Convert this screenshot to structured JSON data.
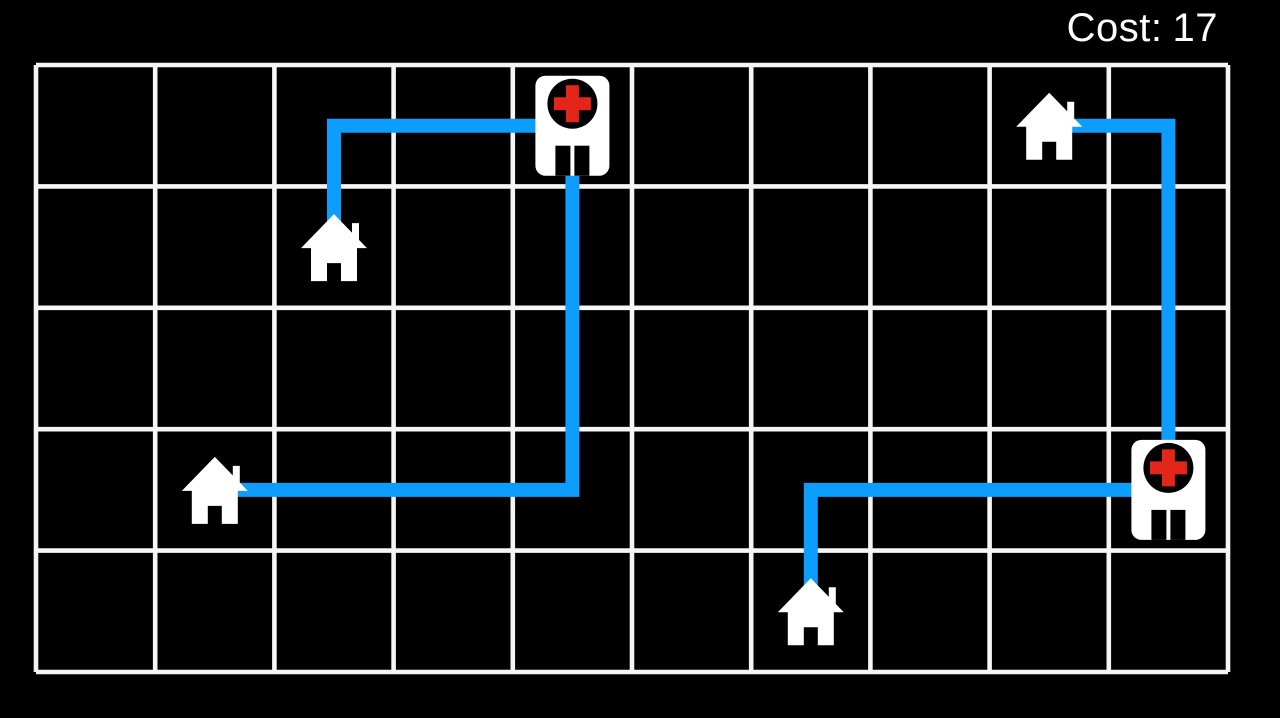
{
  "hud": {
    "label": "Cost:",
    "value": "17"
  },
  "board": {
    "columns": 10,
    "rows": 5,
    "x": 36,
    "y": 65,
    "cell_width": 119.2,
    "cell_height": 121.4,
    "grid_line_width": 4.6
  },
  "style": {
    "background": "#000000",
    "grid_color": "#f5f5f5",
    "route_color": "#0d9dff",
    "route_width": 14,
    "building_color": "#ffffff",
    "cross_color": "#e3261a",
    "icon_contrast_color": "#000000",
    "hud_color": "#ffffff"
  },
  "buildings": [
    {
      "id": "hospital-1",
      "type": "hospital",
      "row": 1,
      "col": 5
    },
    {
      "id": "hospital-2",
      "type": "hospital",
      "row": 4,
      "col": 10
    },
    {
      "id": "house-1",
      "type": "house",
      "row": 2,
      "col": 3
    },
    {
      "id": "house-2",
      "type": "house",
      "row": 4,
      "col": 2
    },
    {
      "id": "house-3",
      "type": "house",
      "row": 1,
      "col": 9
    },
    {
      "id": "house-4",
      "type": "house",
      "row": 5,
      "col": 7
    }
  ],
  "routes": [
    {
      "id": "route-house-1-hospital-1",
      "from": "house-1",
      "to": "hospital-1",
      "cells": [
        [
          2,
          3
        ],
        [
          1,
          3
        ],
        [
          1,
          5
        ]
      ]
    },
    {
      "id": "route-house-2-hospital-1",
      "from": "house-2",
      "to": "hospital-1",
      "cells": [
        [
          4,
          2
        ],
        [
          4,
          5
        ],
        [
          1,
          5
        ]
      ]
    },
    {
      "id": "route-house-3-hospital-2",
      "from": "house-3",
      "to": "hospital-2",
      "cells": [
        [
          1,
          9
        ],
        [
          1,
          10
        ],
        [
          4,
          10
        ]
      ]
    },
    {
      "id": "route-house-4-hospital-2",
      "from": "house-4",
      "to": "hospital-2",
      "cells": [
        [
          5,
          7
        ],
        [
          4,
          7
        ],
        [
          4,
          10
        ]
      ]
    }
  ]
}
